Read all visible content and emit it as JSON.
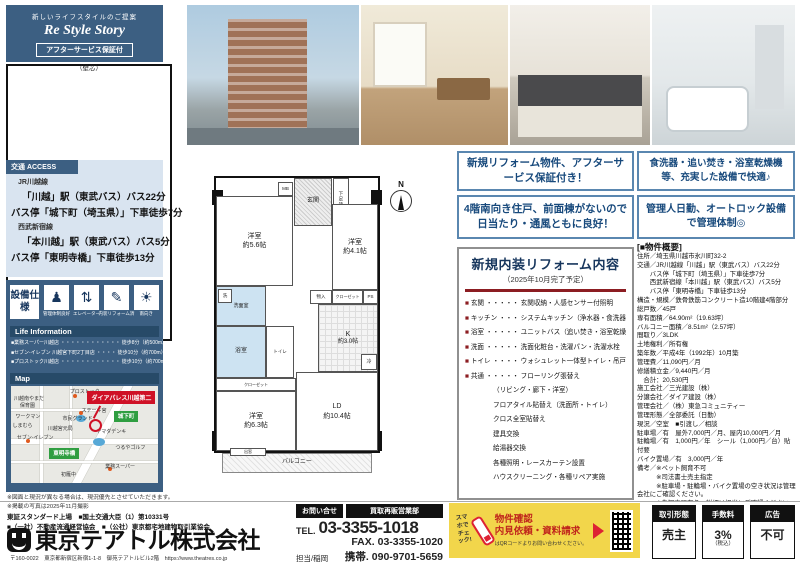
{
  "header": {
    "tagline": "新しいライフスタイルのご提案",
    "brand": "Re Style Story",
    "badge": "アフターサービス保証付",
    "property_name": "ダイアパレス川越第二",
    "layout": "3LDK",
    "area_number": "64.90",
    "area_unit": "m²",
    "area_note": "（壁芯）"
  },
  "access": {
    "title": "交通 ACCESS",
    "lines": [
      {
        "pre": "JR川越線",
        "main": "「川越」駅（東武バス）バス22分"
      },
      {
        "main": "バス停「城下町（埼玉県）」下車徒歩7分"
      },
      {
        "pre": "西武新宿線",
        "main": "「本川越」駅（東武バス）バス5分"
      },
      {
        "main": "バス停「東明寺橋」下車徒歩13分"
      }
    ]
  },
  "equipment": {
    "title": "設備仕様",
    "items": [
      {
        "glyph": "♟",
        "label": "管理体制良好"
      },
      {
        "glyph": "⇅",
        "label": "エレベーター"
      },
      {
        "glyph": "✎",
        "label": "内装リフォーム済"
      },
      {
        "glyph": "☀",
        "label": "南向き"
      }
    ]
  },
  "life_info": {
    "title": "Life Information",
    "items": [
      "■業務スーパー川越店 ・・・・・・・・・・・・ 徒歩8分（約500m）",
      "■セブン-イレブン 川越宮下町2丁目店 ・・・・ 徒歩10分（約700m）",
      "■プロストック川越店 ・・・・・・・・・・・・ 徒歩10分（約700m）"
    ]
  },
  "map": {
    "title": "Map",
    "property_label": "ダイアパレス川越第二",
    "bus_stops": [
      "城下町",
      "東明寺橋"
    ],
    "landmarks": [
      {
        "t": "プロストック",
        "x": 40,
        "y": 3
      },
      {
        "t": "川越南やまだ",
        "x": 2,
        "y": 10
      },
      {
        "t": "保育園",
        "x": 6,
        "y": 17
      },
      {
        "t": "ステーキ宮",
        "x": 48,
        "y": 22
      },
      {
        "t": "ワークマン",
        "x": 3,
        "y": 28
      },
      {
        "t": "しまむら",
        "x": 1,
        "y": 38
      },
      {
        "t": "セブン-イレブン",
        "x": 4,
        "y": 50
      },
      {
        "t": "川越宮元局",
        "x": 25,
        "y": 41
      },
      {
        "t": "市民グランド",
        "x": 35,
        "y": 30
      },
      {
        "t": "ヤマダデンキ",
        "x": 58,
        "y": 44
      },
      {
        "t": "つるやゴルフ",
        "x": 71,
        "y": 60
      },
      {
        "t": "業務スーパー",
        "x": 64,
        "y": 80
      },
      {
        "t": "初雁中",
        "x": 34,
        "y": 88
      }
    ]
  },
  "notes": [
    "※図面と現況が異なる場合は、現況優先とさせていただきます。",
    "※掲載の写真は2025年11月撮影"
  ],
  "company": {
    "listing": "東証スタンダード上場　■国土交通大臣（1）第10331号",
    "associations": "■（一社）不動産流通経営協会　■（公社）東京都宅地建物取引業協会",
    "name": "東京テアトル株式会社",
    "address": "〒160-0022　東京都新宿区新宿1-1-8　御苑テアトルビル2階　https://www.theatres.co.jp"
  },
  "highlights": [
    "新規リフォーム物件、アフターサービス保証付き！",
    "4階南向き住戸、前面棟がないので日当たり・通風ともに良好！",
    "食洗器・追い焚き・浴室乾燥機等、充実した設備で快適♪",
    "管理人日勤、オートロック設備で管理体制◎"
  ],
  "reform": {
    "title": "新規内装リフォーム内容",
    "subtitle": "（2025年10月完了予定）",
    "items": [
      "玄関 ・・・・・ 玄関収納・人感センサー付照明",
      "キッチン ・・・ システムキッチン（浄水器・食洗器付）",
      "浴室 ・・・・・ ユニットバス（追い焚き・浴室乾燥機付）",
      "洗面 ・・・・・ 洗面化粧台・洗濯パン・洗濯水栓",
      "トイレ ・・・・ ウォシュレット一体型トイレ・吊戸棚",
      "共通 ・・・・・ フローリング張替え"
    ],
    "extras": [
      "（リビング・廊下・洋室）",
      "フロアタイル貼替え（洗面所・トイレ）",
      "クロス全室貼替え",
      "建具交換",
      "給湯器交換",
      "各種照明・レースカーテン設置",
      "ハウスクリーニング・各種リペア実施"
    ]
  },
  "overview": {
    "title": "[■物件概要]",
    "lines": [
      "住所／埼玉県川越市氷川町32-2",
      "交通／JR川越線「川越」駅（東武バス）バス22分",
      "　　バス停「城下町（埼玉県）」下車徒歩7分",
      "　　西武新宿線「本川越」駅（東武バス）バス5分",
      "　　バス停「東明寺橋」下車徒歩13分",
      "構造・規模／鉄骨鉄筋コンクリート造10階建4階部分",
      "総戸数／45戸",
      "専有面積／64.90m²（19.63坪）",
      "バルコニー面積／8.51m²（2.57坪）",
      "間取り／3LDK",
      "土地権利／所有権",
      "築年数／平成4年（1992年）10月築",
      "管理費／11,090円／月",
      "修繕積立金／9,440円／月",
      "　合計：20,530円",
      "施工会社／三光建設（株）",
      "分譲会社／ダイア建設（株）",
      "管理会社／（株）東急コミュニティー",
      "管理形態／全部委託（日勤）",
      "現況／空室　■引渡し／相談",
      "駐車場／有　屋外7,000円／月、屋内10,000円／月",
      "駐輪場／有　1,000円／年　シール（1,000円／台）貼付要",
      "バイク置場／有　3,000円／年",
      "備考／※ペット飼育不可",
      "　　　※司法書士売主指定",
      "　　　※駐車場・駐輪場・バイク置場の空き状況は管理会社にご確認ください。",
      "　　　※告知事項有り、詳細は担当にご確認ください。"
    ]
  },
  "floorplan": {
    "compass": "N",
    "rooms": {
      "west1_name": "洋室",
      "west1_size": "約5.6帖",
      "west2_name": "洋室",
      "west2_size": "約4.1帖",
      "west3_name": "洋室",
      "west3_size": "約6.3帖",
      "ld_name": "LD",
      "ld_size": "約10.4帖",
      "k_name": "K",
      "k_size": "約3.0帖"
    },
    "labels": {
      "genkan": "玄関",
      "mb": "MB",
      "shoe": "下足箱",
      "wash": "洗",
      "washroom": "洗面室",
      "bath": "浴室",
      "toilet": "トイレ",
      "closet": "クローゼット",
      "storage": "物入",
      "ps": "PS",
      "fridge": "冷",
      "balcony": "バルコニー",
      "bay": "出窓"
    }
  },
  "contact": {
    "inquiry_label": "お問い合せ",
    "dept": "買取再販営業部",
    "tel_label": "TEL.",
    "tel": "03-3355-1018",
    "fax_label": "FAX.",
    "fax": "03-3355-1020",
    "person": "担当/稲岡",
    "mobile_label": "携帯.",
    "mobile": "090-9701-5659"
  },
  "qr_box": {
    "check": "スマホで チェック!",
    "line1": "物件確認",
    "line2": "内見依頼・資料請求",
    "line3": "はQRコードよりお問い合わせください。"
  },
  "deal": [
    {
      "label": "取引形態",
      "value": "売主",
      "note": ""
    },
    {
      "label": "手数料",
      "value": "3%",
      "note": "（税込）"
    },
    {
      "label": "広告",
      "value": "不可",
      "note": ""
    }
  ],
  "colors": {
    "navy": "#3c5f82",
    "light_panel": "#dfe3ed",
    "access_bg": "#d9e4f0",
    "highlight_border": "#5a87b0",
    "highlight_text": "#17497c",
    "reform_rule": "#8c1d22",
    "map_red": "#cf1126",
    "map_green": "#2f9e41",
    "qr_yellow": "#f2d64b"
  }
}
